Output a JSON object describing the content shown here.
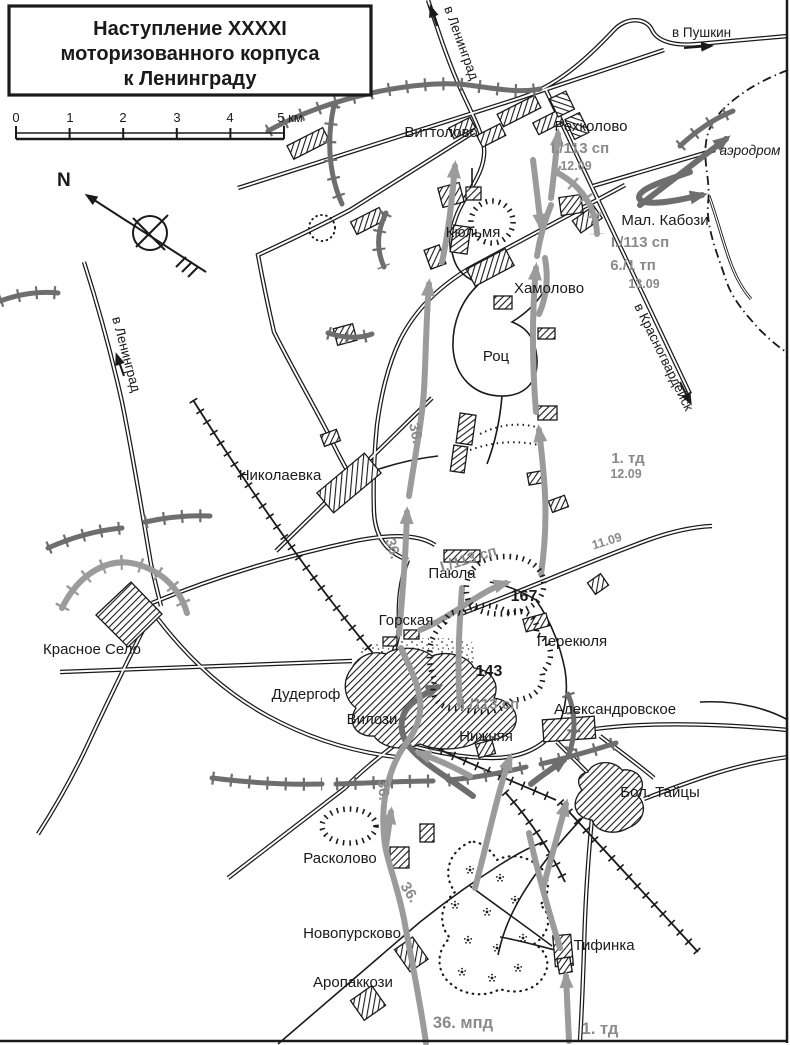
{
  "title": {
    "lines": [
      "Наступление XXXXI",
      "моторизованного корпуса",
      "к Ленинграду"
    ]
  },
  "scale_bar": {
    "labels": [
      "0",
      "1",
      "2",
      "3",
      "4",
      "5 км"
    ]
  },
  "compass": {
    "north": "N"
  },
  "colors": {
    "ink": "#1a1a1a",
    "front_line_gray": "#6e6e6e",
    "movement_gray": "#9b9b9b",
    "unit_text_gray": "#8a8a8a",
    "background": "#ffffff"
  },
  "road_labels": {
    "to_leningrad": "в Ленинград",
    "to_pushkin": "в Пушкин",
    "to_krasnogvardeysk": "в Красногвардейск",
    "airfield": "аэродром"
  },
  "places": {
    "vittolovo": "Виттолово",
    "rehkolovo": "Рехколово",
    "kyulmya": "Кюльмя",
    "mal_kabozi": "Мал. Кабози",
    "hamolovo": "Хамолово",
    "rots": "Роц",
    "nikolaevka": "Николаевка",
    "payula": "Паюла",
    "gorskaya": "Горская",
    "perekyulya": "Перекюля",
    "krasnoe_selo": "Красное Село",
    "dudergof": "Дудергоф",
    "vilozi": "Вилози",
    "aleksandrovskoe": "Александровское",
    "nizhnyaya": "Нижняя",
    "bol_taytsy": "Бол. Тайцы",
    "raskolovo": "Расколово",
    "novopurskovo": "Новопурсково",
    "aropakkozi": "Аропаккози",
    "tifinka": "Тифинка"
  },
  "units": {
    "i113_1": "I./113 сп",
    "date_1": "12.09",
    "i113_2": "I./113 сп",
    "tp_2": "6./1 тп",
    "date_2": "13.09",
    "td1_mid": "1. тд",
    "date_3": "12.09",
    "i113_3": "I./113 сп",
    "date_4": "11.09",
    "i113_4": "I./113 сп",
    "r36": "36.",
    "mpd36": "36. мпд",
    "td1_bottom": "1. тд",
    "pocket167": "167",
    "pocket143": "143"
  }
}
